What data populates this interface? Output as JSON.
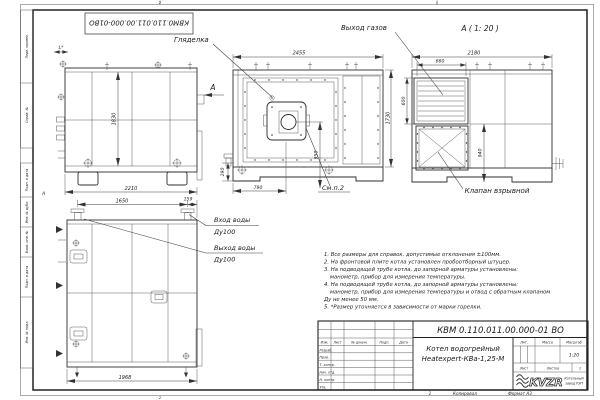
{
  "sheet": {
    "top_stamp": "КВМ0.110.011.00.000-01ВО",
    "zone_top_left": "2",
    "zone_top_right": "1",
    "zone_bottom": "2",
    "zone_letter": "А",
    "margin_labels_top": [
      "Перв. примен.",
      "Справ. №"
    ],
    "margin_labels_bottom": [
      "Подп. и дата",
      "Инв. № дубл.",
      "Взам. инв. №",
      "Подп. и дата",
      "Инв. № подл."
    ]
  },
  "views": {
    "side_top": {
      "dim_l": "L*",
      "dim_h": "1830",
      "dim_w": "2210",
      "view_arrow": "А"
    },
    "front": {
      "label_sight_glass": "Гляделка",
      "dim_top": "2455",
      "dim_right": "1730",
      "dim_burner": "950",
      "dim_bottom": "790",
      "dim_base": "290",
      "note_ref": "См.п.2"
    },
    "rear": {
      "view_title": "А ( 1: 20 )",
      "label_gas_outlet": "Выход газов",
      "label_explosion_valve": "Клапан взрывной",
      "dim_top": "2180",
      "dim_gas_w": "660",
      "dim_gas_h": "600",
      "dim_right": "940"
    },
    "side_bottom": {
      "dim_top": "1650",
      "dim_top_right": "159",
      "dim_bottom": "1968",
      "label_water_in": "Вход воды",
      "label_water_in_dn": "Ду100",
      "label_water_out": "Выход воды",
      "label_water_out_dn": "Ду100"
    }
  },
  "notes": {
    "lines": [
      "1. Все размеры для справок, допустимые отклонения ±100мм.",
      "2. На фронтовой плите котла установлен пробоотборный штуцер.",
      "3. На подводящей трубе котла, до запорной арматуры установлены:",
      "манометр, прибор для измерения температуры.",
      "4. На подводящей трубе котла, до запорной арматуры установлены:",
      "манометр, прибор для измерения температуры и отвод с обратным клапаном",
      "Ду не менее 50 мм.",
      "5. *Размер уточняется в зависимости от марки горелки."
    ]
  },
  "title_block": {
    "doc_number": "КВМ 0.110.011.00.000-01 ВО",
    "product_line1": "Котел водогрейный",
    "product_line2": "Heatexpert-КВа-1,25-М",
    "col_izm": "Изм.",
    "col_list": "Лист",
    "col_doc": "№ докум.",
    "col_podp": "Подп.",
    "col_data": "Дата",
    "rows": [
      "Разраб.",
      "Пров.",
      "Т. контр.",
      "Нач. отд.",
      "Н. контр.",
      "Утв."
    ],
    "lit": "Лит.",
    "mass": "Масса",
    "scale_label": "Масштаб",
    "scale_value": "1:20",
    "sheet_label": "Лист",
    "sheets_label": "Листов",
    "sheets_value": "1",
    "logo": "KVZR",
    "logo_caption1": "Котельный",
    "logo_caption2": "завод РЭП",
    "footer_num": "1",
    "footer_copy": "Копировал",
    "footer_format": "Формат А3"
  }
}
